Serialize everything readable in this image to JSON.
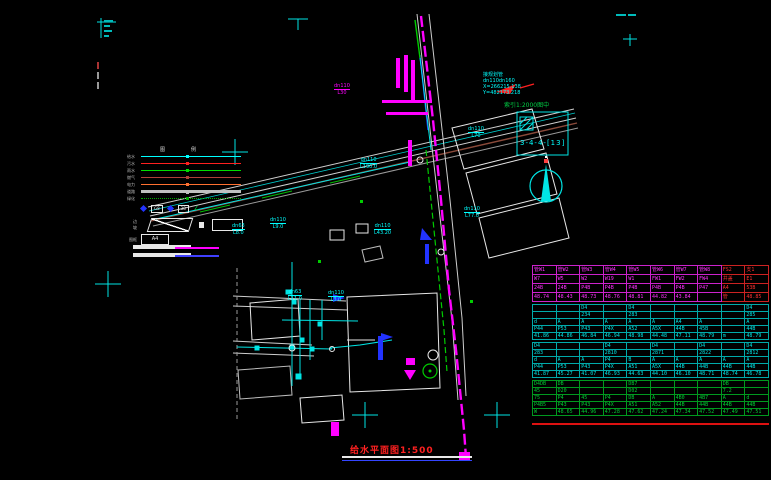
{
  "palette": {
    "cyan": "#00ffff",
    "magenta": "#ff00ff",
    "green": "#00dd00",
    "red": "#ff2020",
    "blue": "#2233ff",
    "white": "#e8e8e8",
    "brown": "#8b4a3a"
  },
  "title_block": {
    "title": "给水平面图1:500"
  },
  "index_box": {
    "note": "索引1:2000图中",
    "ref": "3-4-4-[13]"
  },
  "coord_note": {
    "l1": "接规划管",
    "l2": "dn110dn160",
    "l3": "X=266215.138",
    "l4": "Y=482173.218"
  },
  "legend": {
    "header": "图例",
    "rows": [
      {
        "label": "给水",
        "color": "#00ffff",
        "style": "solid"
      },
      {
        "label": "污水",
        "color": "#ff2020",
        "style": "solid"
      },
      {
        "label": "雨水",
        "color": "#00dd00",
        "style": "solid"
      },
      {
        "label": "燃气",
        "color": "#b04038",
        "style": "solid"
      },
      {
        "label": "电力",
        "color": "#ff7030",
        "style": "solid"
      },
      {
        "label": "道路",
        "color": "#c0c0c0",
        "style": "thick"
      },
      {
        "label": "绿化",
        "color": "#00aa00",
        "style": "dotted"
      }
    ],
    "symbol_row": {
      "code1": "G8",
      "code2": "38",
      "zmark": "∠"
    },
    "slope_label": "边坡",
    "house_label": "房屋",
    "a4_prefix": "图框",
    "a4": "A4",
    "sample_magenta": "#ff00ff",
    "sample_blue": "#4040ff"
  },
  "annotations": [
    {
      "l1": "dn110",
      "l2": "L30",
      "c": "#ff00ff",
      "x": 334,
      "y": 83
    },
    {
      "l1": "dn110",
      "l2": "L190.0",
      "c": "#00ffff",
      "x": 360,
      "y": 157
    },
    {
      "l1": "dn63",
      "l2": "L8.0",
      "c": "#00ffff",
      "x": 232,
      "y": 223
    },
    {
      "l1": "dn110",
      "l2": "L9.0",
      "c": "#00ffff",
      "x": 270,
      "y": 217
    },
    {
      "l1": "dn110",
      "l2": "L43.20",
      "c": "#00ffff",
      "x": 374,
      "y": 223
    },
    {
      "l1": "dn110",
      "l2": "L77.0",
      "c": "#00ffff",
      "x": 464,
      "y": 206
    },
    {
      "l1": "dn110",
      "l2": "L70",
      "c": "#00ffff",
      "x": 468,
      "y": 126
    },
    {
      "l1": "dn63",
      "l2": "L11.0",
      "c": "#00ffff",
      "x": 288,
      "y": 289
    },
    {
      "l1": "dn110",
      "l2": "L3.0",
      "c": "#00ffff",
      "x": 328,
      "y": 290
    }
  ],
  "table": {
    "groups": [
      {
        "style": "g1",
        "rows": [
          [
            "管W1",
            "管W2",
            "管W3",
            "管W4",
            "管W5",
            "管W6",
            "管W7",
            "管W8",
            "FS2",
            "支1"
          ],
          [
            "W7",
            "W5",
            "W2",
            "W19",
            "W1",
            "FW1",
            "FW2",
            "FW4",
            "井盖",
            "E1"
          ],
          [
            "24B",
            "24B",
            "P4B",
            "P4B",
            "P4B",
            "P4B",
            "P4B",
            "P47",
            "A4",
            "53B"
          ],
          [
            "48.74",
            "48.43",
            "48.73",
            "48.76",
            "48.81",
            "44.82",
            "43.84",
            "",
            "管",
            "48.85"
          ]
        ]
      },
      {
        "style": "g2",
        "rows": [
          [
            "",
            "",
            "D4",
            "",
            "D4",
            "",
            "",
            "",
            "",
            "D4"
          ],
          [
            "",
            "",
            "234",
            "",
            "283",
            "",
            "",
            "",
            "",
            "285"
          ],
          [
            "d",
            "A",
            "A",
            "A",
            "A",
            "A",
            "A4",
            "A",
            "",
            "A"
          ],
          [
            "P44",
            "P53",
            "P43",
            "P4X",
            "A52",
            "A5X",
            "44B",
            "45B",
            "",
            "44B"
          ],
          [
            "41.86",
            "44.86",
            "46.84",
            "46.94",
            "48.98",
            "44.48",
            "47.11",
            "48.79",
            "m",
            "48.79"
          ]
        ]
      },
      {
        "style": "g3",
        "rows": [
          [
            "D4",
            "",
            "",
            "D4",
            "",
            "D4",
            "",
            "D4",
            "",
            "D4"
          ],
          [
            "283",
            "",
            "",
            "2810",
            "",
            "2871",
            "",
            "2822",
            "",
            "2812"
          ],
          [
            "d",
            "A",
            "A",
            "P4",
            "B",
            "A",
            "A",
            "A",
            "A",
            "A"
          ],
          [
            "P44",
            "P53",
            "P43",
            "P4X",
            "A51",
            "A5X",
            "44B",
            "44B",
            "44B",
            "44B"
          ],
          [
            "41.87",
            "45.27",
            "41.07",
            "46.93",
            "44.63",
            "44.10",
            "46.10",
            "48.71",
            "48.74",
            "46.78"
          ]
        ]
      },
      {
        "style": "g4",
        "rows": [
          [
            "D4DB",
            "DB",
            "",
            "",
            "DB7",
            "",
            "",
            "",
            "DB",
            ""
          ],
          [
            "45",
            "D20",
            "",
            "",
            "D02",
            "",
            "",
            "",
            "7.2",
            ""
          ],
          [
            "75",
            "P4",
            "45",
            "P4",
            "DB",
            "A",
            "4B0",
            "4B7",
            "A",
            "d"
          ],
          [
            "P4B5",
            "P43",
            "P43",
            "P4X",
            "A51",
            "A52",
            "44B",
            "44B",
            "44B",
            "44B"
          ],
          [
            "W",
            "48.65",
            "44.96",
            "47.28",
            "47.62",
            "47.24",
            "47.34",
            "47.52",
            "47.49",
            "47.51"
          ]
        ]
      }
    ]
  }
}
